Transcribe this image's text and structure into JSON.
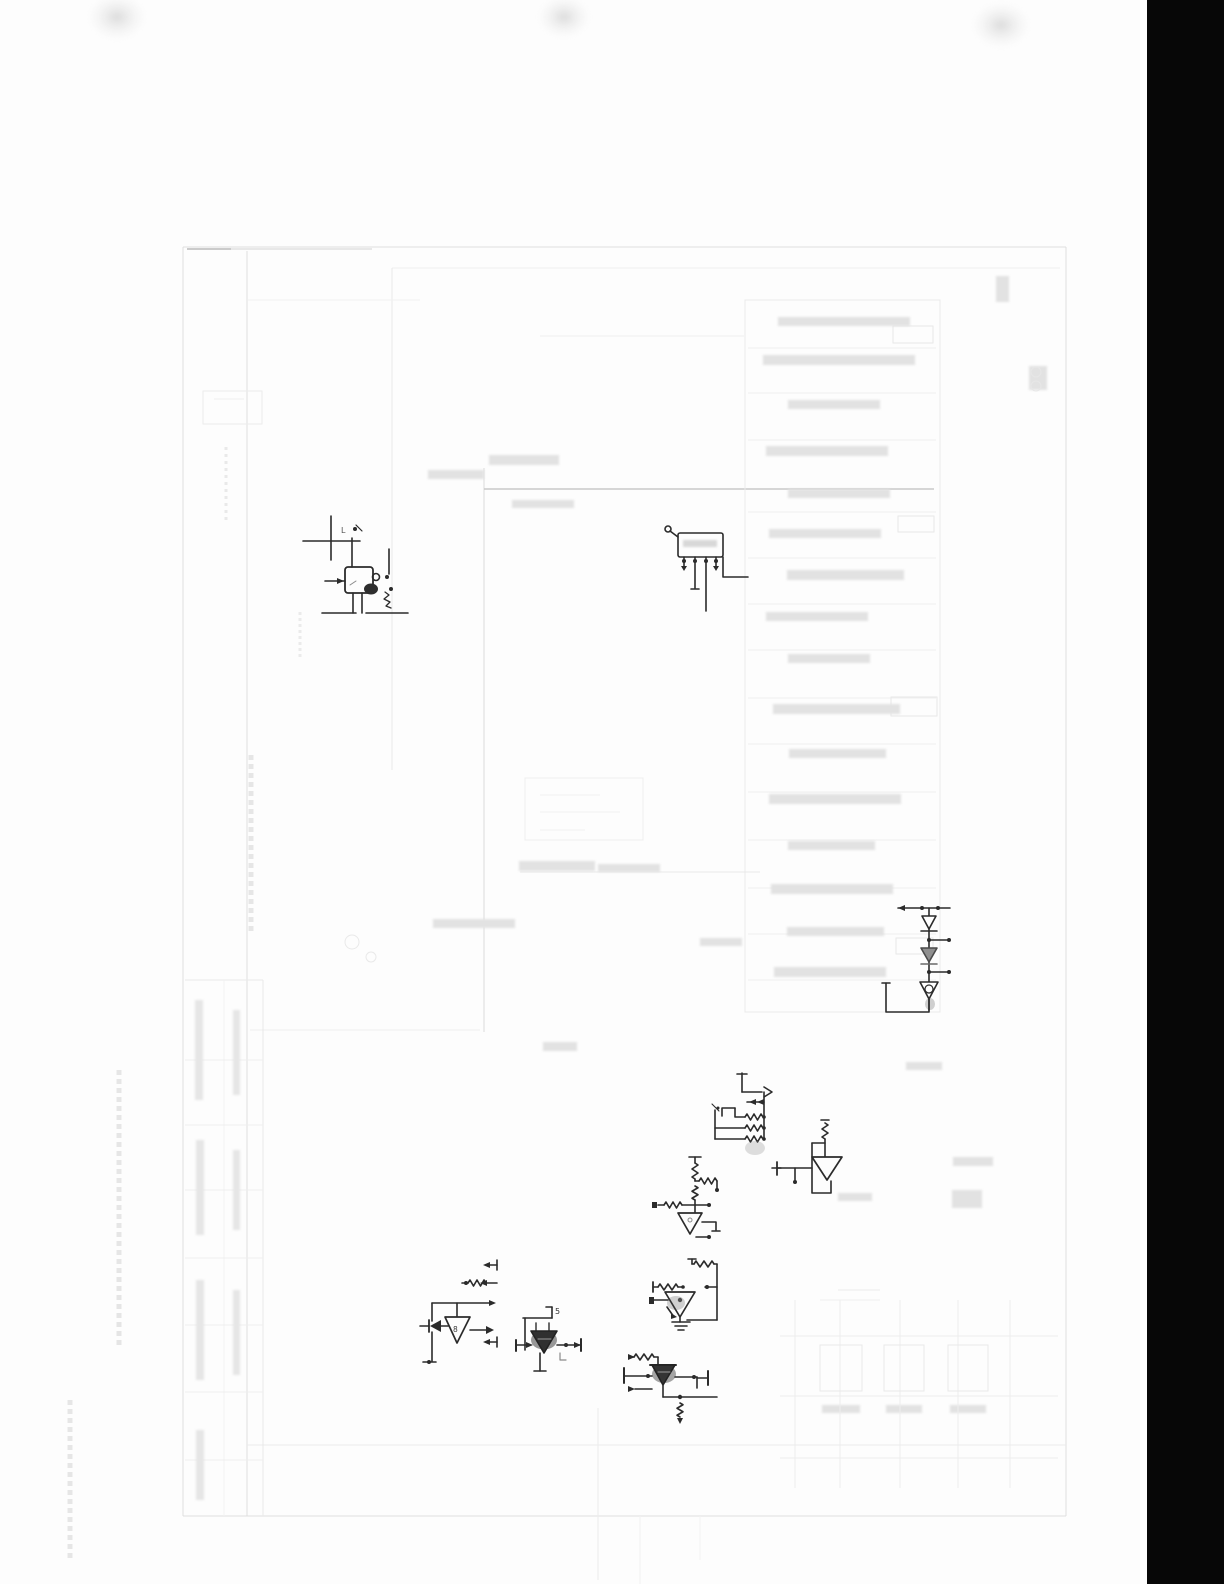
{
  "page": {
    "paper_color": "#fdfdfd",
    "ink_color": "#2b2b2b",
    "ghost_color": "#e3e3e3",
    "scan_bar_color": "#070707"
  },
  "labels": {
    "comp_a_mark": "L",
    "comp_i_mark": "8",
    "comp_j_mark": "5"
  },
  "components": [
    {
      "name": "capacitor-transistor-block"
    },
    {
      "name": "ic-block-with-pins"
    },
    {
      "name": "diode-chain"
    },
    {
      "name": "resistor-network"
    },
    {
      "name": "buffer-amp"
    },
    {
      "name": "opamp-ladder"
    },
    {
      "name": "opamp-2"
    },
    {
      "name": "power-stage"
    },
    {
      "name": "opamp-with-diode"
    },
    {
      "name": "dark-transistor"
    }
  ]
}
